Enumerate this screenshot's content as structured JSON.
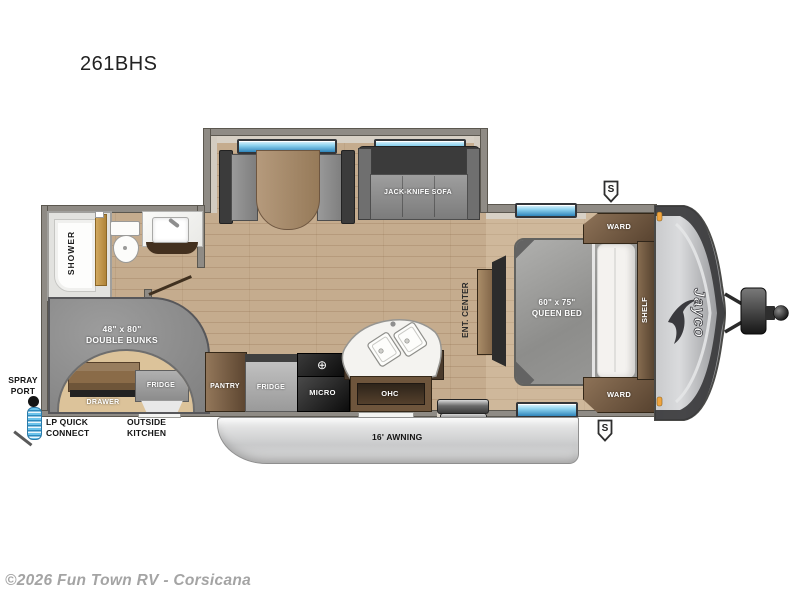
{
  "title": "261BHS",
  "watermark": "©2026 Fun Town RV - Corsicana",
  "slide": {
    "sofa_label": "JACK-KNIFE SOFA"
  },
  "bathroom": {
    "shower": "SHOWER"
  },
  "bunks": {
    "size": "48\" x 80\"",
    "name": "DOUBLE BUNKS",
    "drawer": "DRAWER",
    "fridge": "FRIDGE"
  },
  "kitchen": {
    "pantry": "PANTRY",
    "fridge": "FRIDGE",
    "micro": "MICRO",
    "ohc": "OHC"
  },
  "bedroom": {
    "ent_center": "ENT. CENTER",
    "bed_size": "60\" x 75\"",
    "bed_name": "QUEEN BED",
    "ward_top": "WARD",
    "ward_bottom": "WARD",
    "shelf": "SHELF"
  },
  "exterior": {
    "spray1": "SPRAY",
    "spray2": "PORT",
    "lp1": "LP QUICK",
    "lp2": "CONNECT",
    "ok1": "OUTSIDE",
    "ok2": "KITCHEN",
    "awning": "16' AWNING",
    "speaker": "S",
    "brand": "Jayco"
  },
  "icons": {
    "burner": "⊕"
  },
  "colors": {
    "floor_wood": "#c5ac8e",
    "wall": "#8f8b85",
    "window_blue": "#5ec1ea",
    "cap_gray": "#c9cacc",
    "awning_gray": "#d9d9d9",
    "coil_blue": "#58b7e4",
    "shower_door_gold": "#c8a255",
    "label_white": "#ffffff",
    "text_black": "#141414",
    "watermark_gray": "#a4a4a4"
  }
}
